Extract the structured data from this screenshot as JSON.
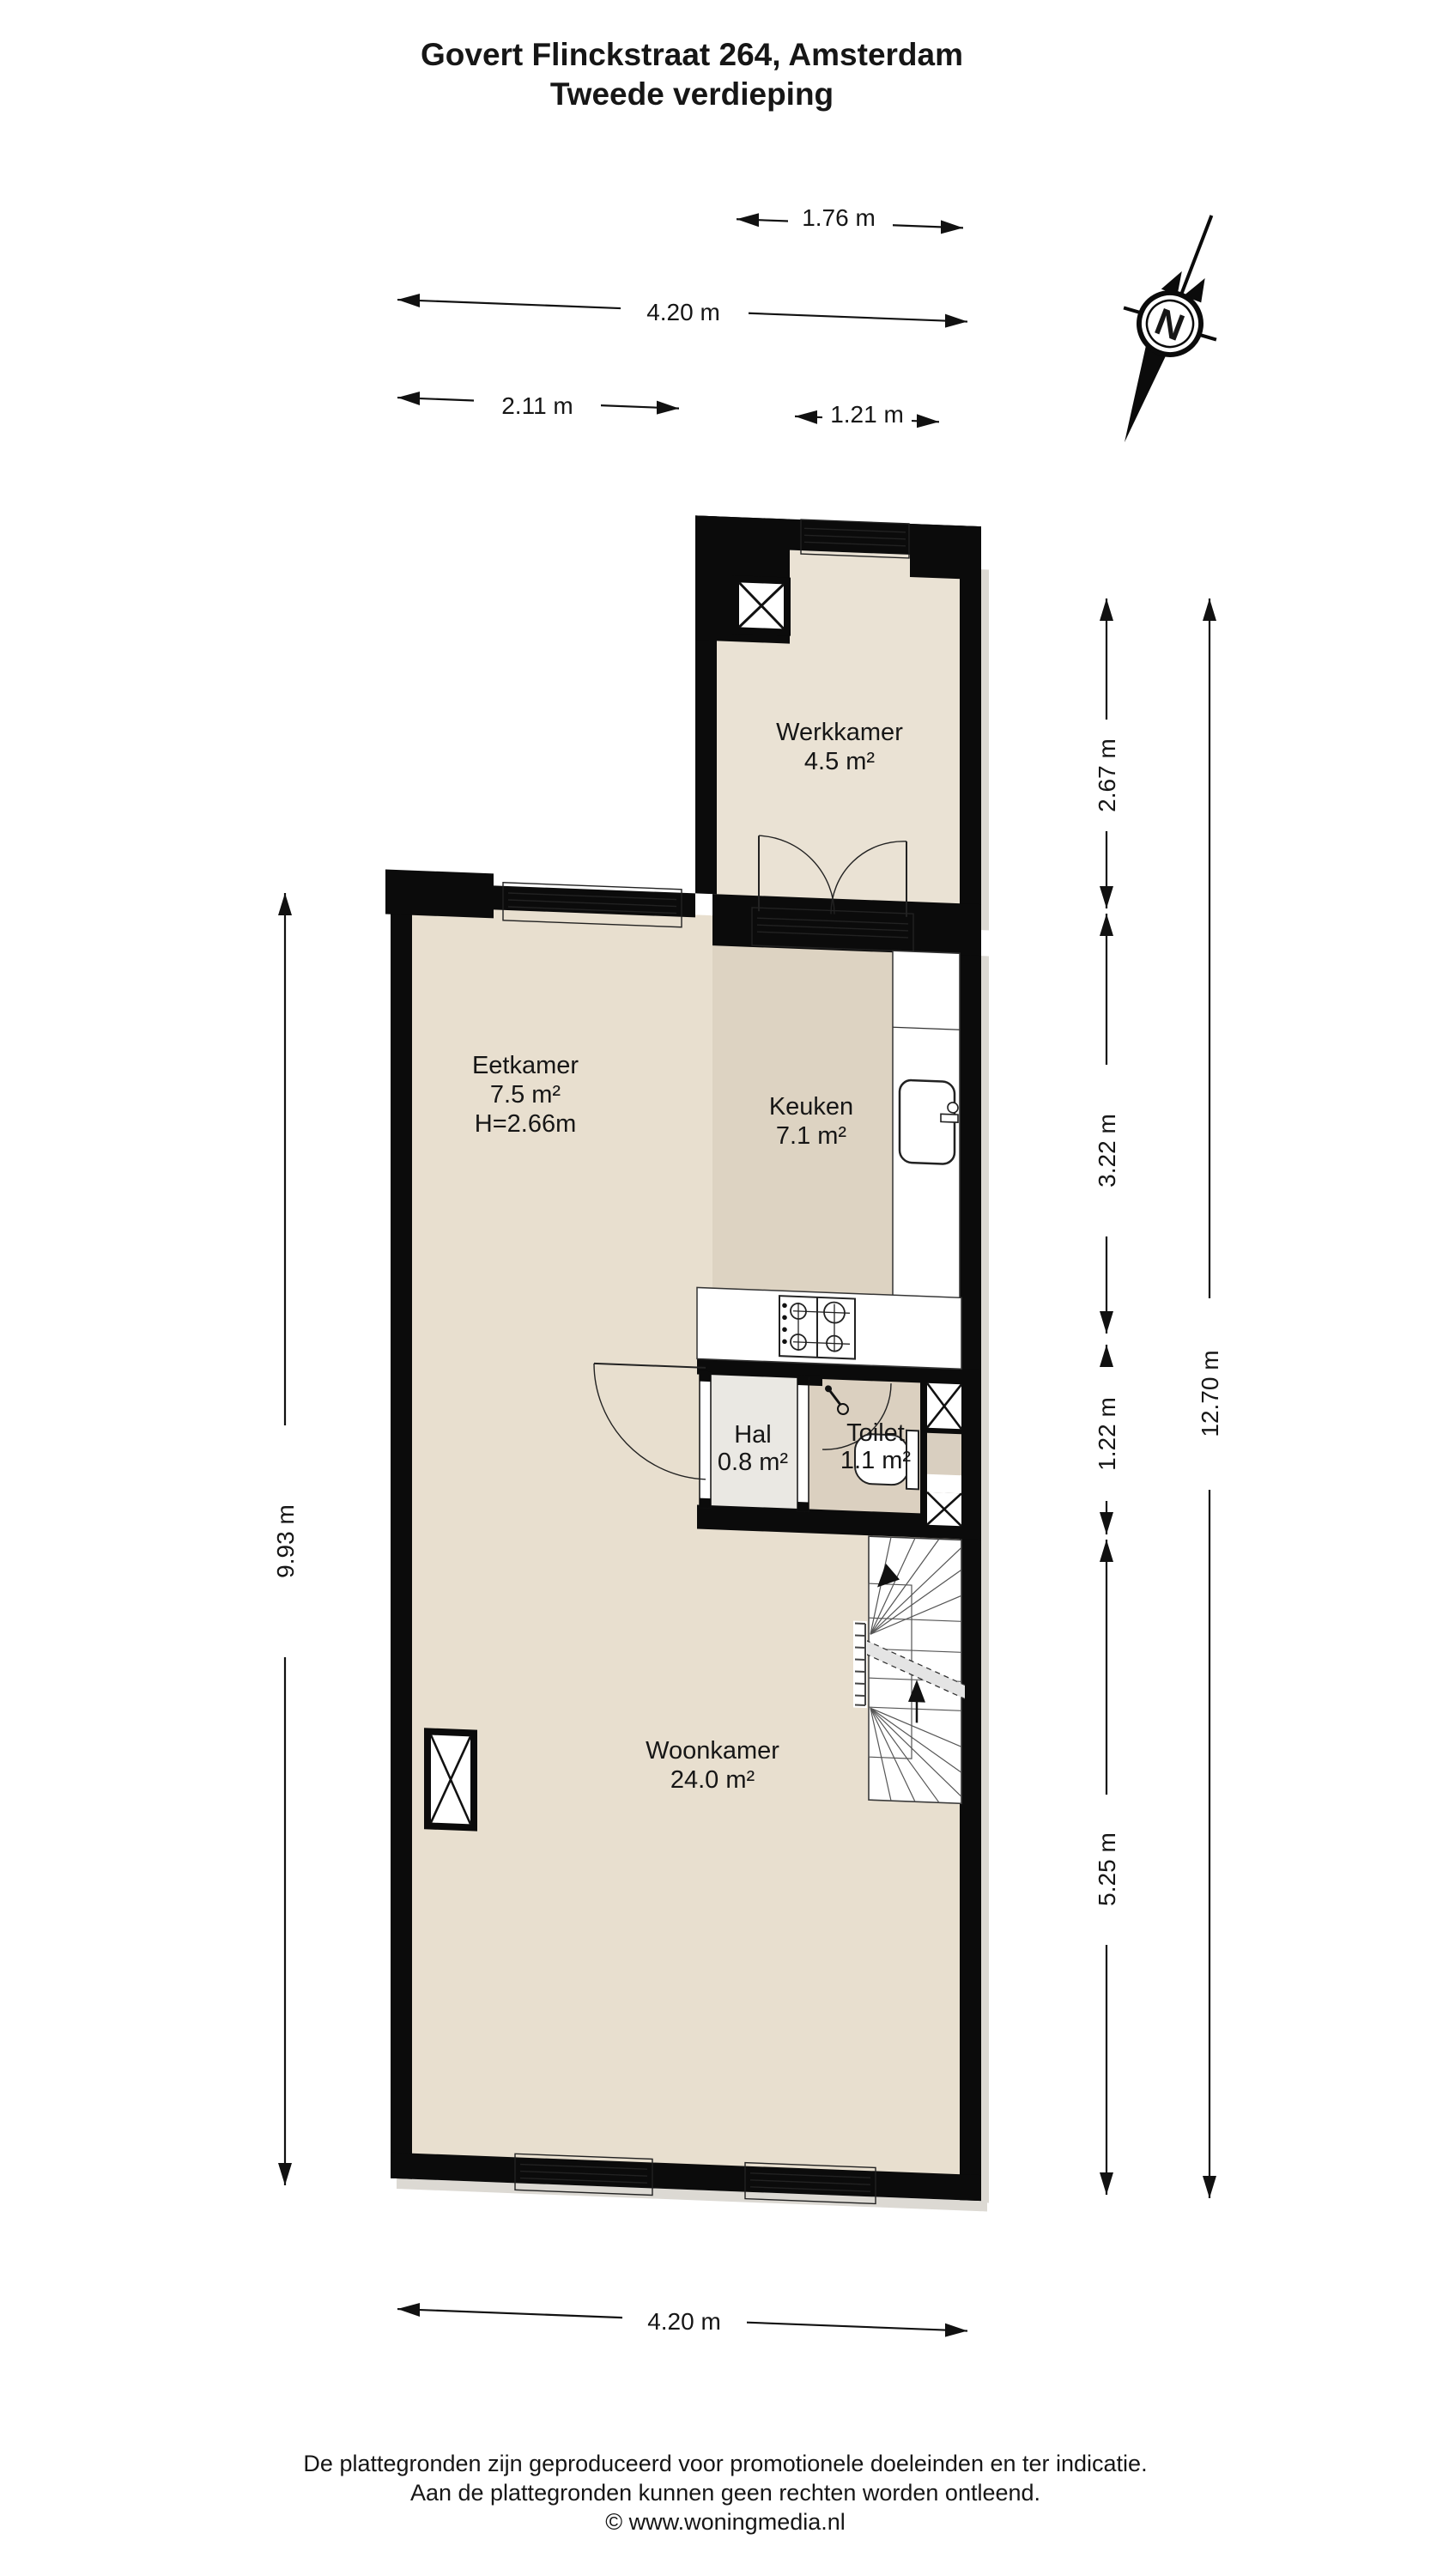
{
  "title": {
    "line1": "Govert Flinckstraat 264, Amsterdam",
    "line2": "Tweede verdieping"
  },
  "compass": {
    "label": "N"
  },
  "rooms": {
    "werkkamer": {
      "name": "Werkkamer",
      "area": "4.5 m²"
    },
    "eetkamer": {
      "name": "Eetkamer",
      "area": "7.5 m²",
      "height": "H=2.66m"
    },
    "keuken": {
      "name": "Keuken",
      "area": "7.1 m²"
    },
    "hal": {
      "name": "Hal",
      "area": "0.8 m²"
    },
    "toilet": {
      "name": "Toilet",
      "area": "1.1 m²"
    },
    "woonkamer": {
      "name": "Woonkamer",
      "area": "24.0 m²"
    }
  },
  "dims": {
    "top_werkkamer": "1.76 m",
    "top_full": "4.20 m",
    "top_left": "2.11 m",
    "top_right": "1.21 m",
    "right_werkkamer": "2.67 m",
    "right_keuken": "3.22 m",
    "right_hal": "1.22 m",
    "right_woonkamer": "5.25 m",
    "right_total": "12.70 m",
    "left_main": "9.93 m",
    "bottom_full": "4.20 m"
  },
  "footer": {
    "line1": "De plattegronden zijn geproduceerd voor promotionele doeleinden en ter indicatie.",
    "line2": "Aan de plattegronden kunnen geen rechten worden ontleend.",
    "line3": "© www.woningmedia.nl"
  },
  "colors": {
    "wall": "#0b0b0b",
    "floor_main": "#e8dfcf",
    "floor_keuken": "#ddd3c2",
    "floor_werkkamer": "#eae2d4",
    "floor_hal": "#eae8e3",
    "floor_toilet": "#dbd0c0",
    "background": "#ffffff"
  }
}
